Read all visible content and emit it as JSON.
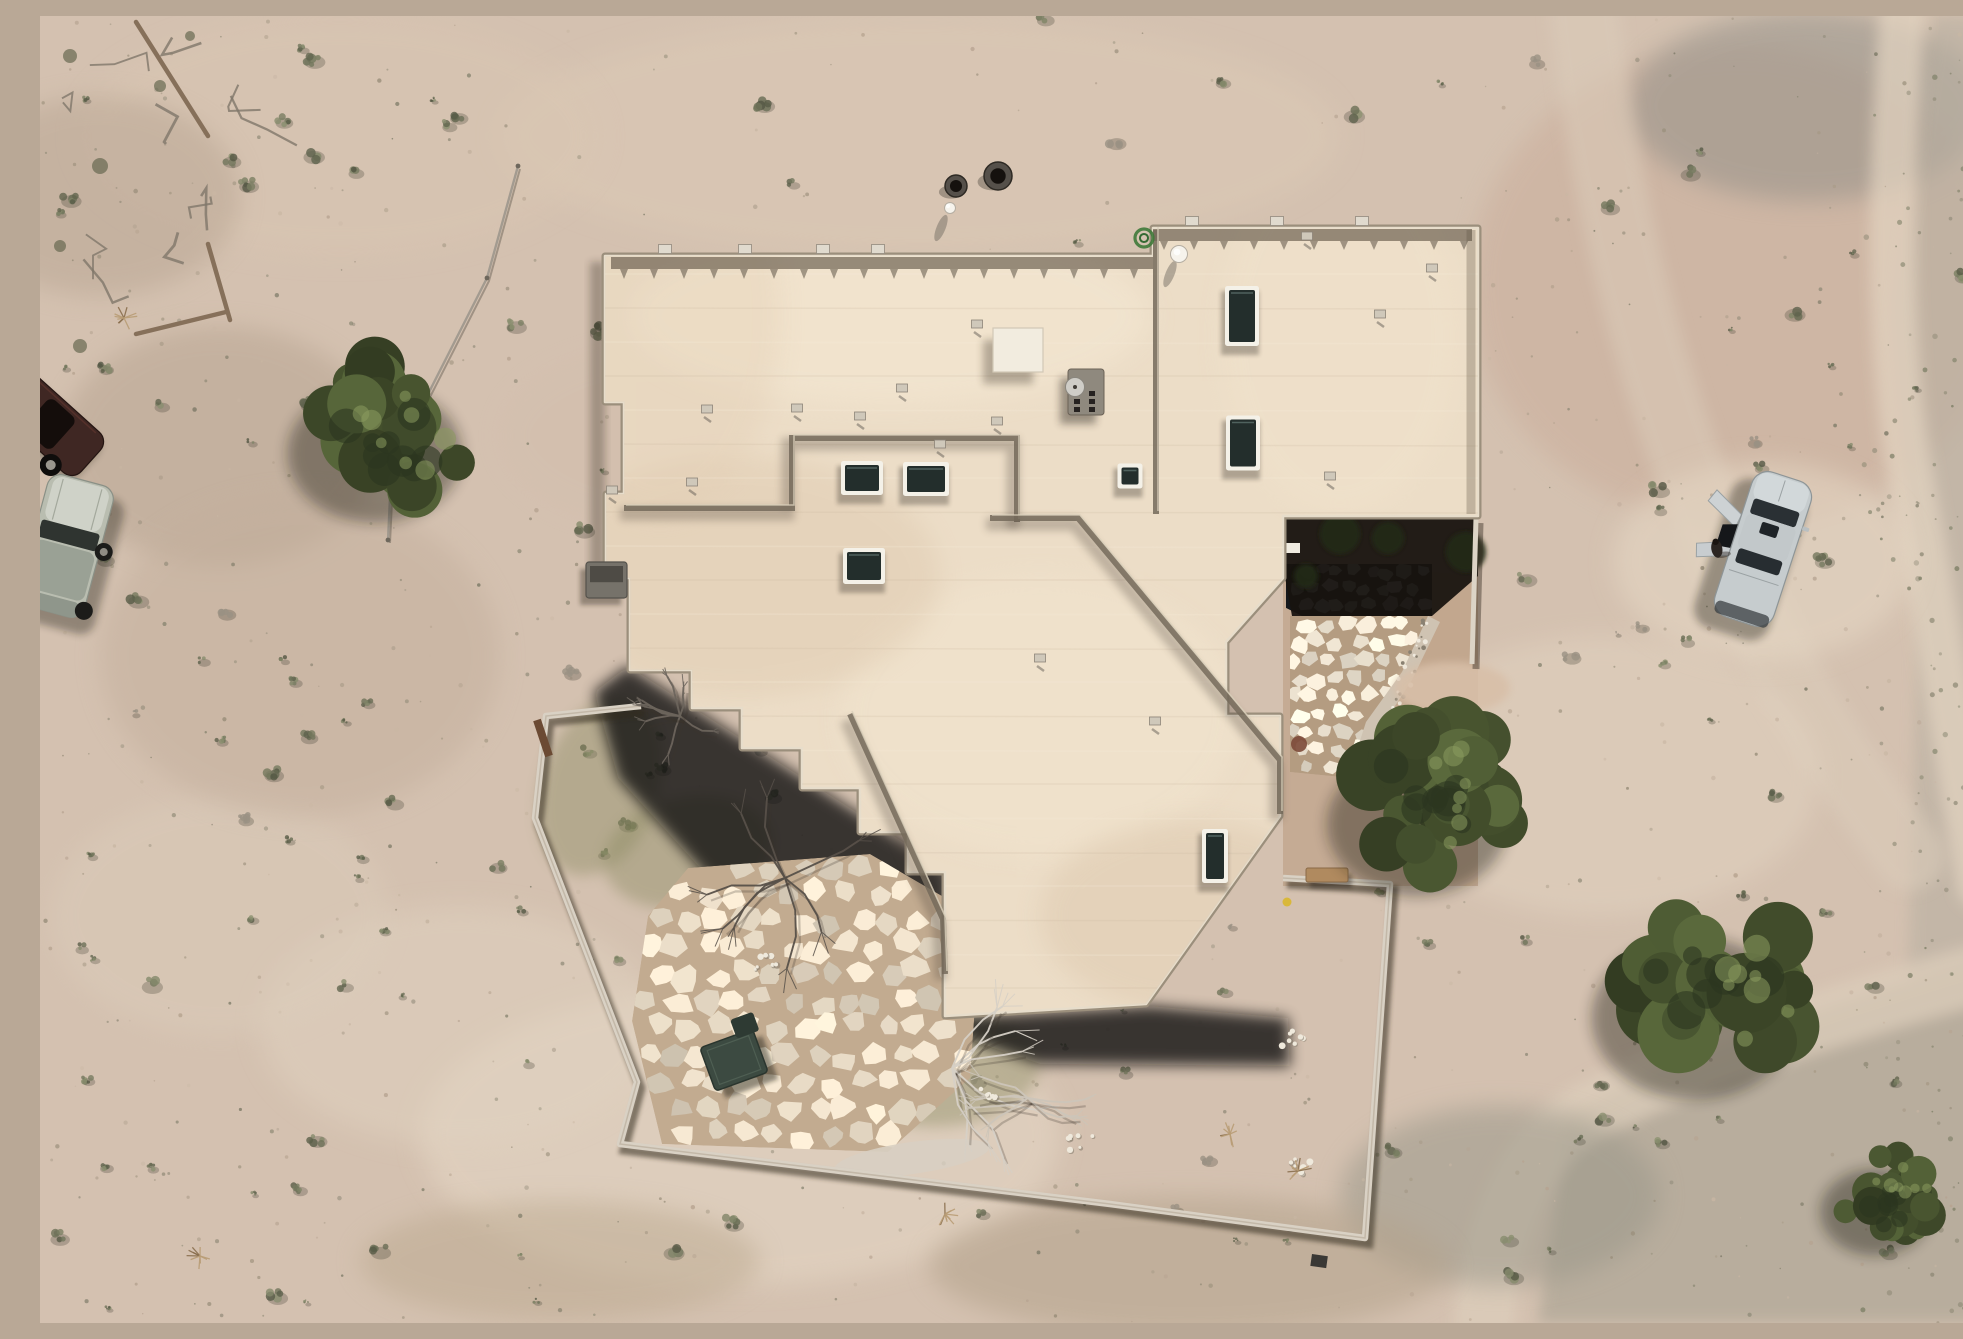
{
  "scene": {
    "type": "aerial-drone-photograph",
    "description": "Top-down aerial drone photograph of a flat-roofed adobe-style desert home with skylights, a walled backyard, flagstone entry courtyard and patio, juniper trees, desert scrub, and three vehicles parked on bare sand",
    "width": 1963,
    "height": 1307
  },
  "palette": {
    "sand": "#d4c1b0",
    "sand_light": "#e3d4c2",
    "sand_dark": "#c0ab99",
    "rocky": "#c6bab0",
    "gravel_zone": "#b2a999",
    "road": "#ddcebb",
    "roof": "#ecddc7",
    "roof_edge_light": "#e7ddcb",
    "parapet": "#9b8f7c",
    "shadow": "#0f0b07",
    "wall": "#d9d1c4",
    "wall_shadow": "#32291f",
    "stone_warm": "#e9dcc7",
    "grout_warm": "#c2ab90",
    "stone_cool": "#97a0a8",
    "grout_cool": "#15181c",
    "tree_green": "#47532f",
    "bare_branch": "#d6d0c6",
    "skylight_glass": "#232e2c",
    "skylight_frame": "#f4f1e8",
    "car_silver": "#c6ccce",
    "car_dark_red": "#3f2723",
    "car_sage": "#b9bdb0"
  },
  "ground": {
    "base": "#d4c1b0",
    "light_patches": [
      [
        700,
        1120,
        320,
        150,
        "#e6d8c6",
        0.55
      ],
      [
        420,
        1010,
        200,
        120,
        "#e0d2c0",
        0.5
      ],
      [
        880,
        120,
        420,
        120,
        "#dccab6",
        0.5
      ],
      [
        1560,
        760,
        220,
        140,
        "#e4d6c3",
        0.45
      ],
      [
        1723,
        545,
        150,
        100,
        "#e6d8c5",
        0.55
      ],
      [
        300,
        120,
        260,
        120,
        "#d9c6b2",
        0.5
      ],
      [
        620,
        420,
        160,
        90,
        "#d2bead",
        0.4
      ],
      [
        180,
        900,
        170,
        120,
        "#dccdbb",
        0.45
      ]
    ],
    "dark_patches": [
      [
        180,
        430,
        160,
        120,
        "#b5a28f",
        0.5
      ],
      [
        60,
        180,
        140,
        100,
        "#b7a492",
        0.5
      ],
      [
        1460,
        1180,
        160,
        90,
        "#9b988a",
        0.55
      ],
      [
        520,
        1245,
        200,
        60,
        "#bba98f",
        0.5
      ],
      [
        1150,
        1250,
        260,
        70,
        "#b3a28b",
        0.55
      ],
      [
        260,
        640,
        200,
        160,
        "#c3af9c",
        0.5
      ]
    ],
    "top_right_mound": [
      1700,
      270,
      270,
      240,
      "#cdb4a2",
      0.8
    ],
    "top_right_stain": [
      1768,
      90,
      180,
      95,
      "#8f8d86",
      0.5
    ],
    "right_strip": [
      [
        1895,
        0
      ],
      [
        1963,
        0
      ],
      [
        1963,
        950
      ],
      [
        1868,
        965
      ],
      [
        1878,
        600
      ],
      [
        1856,
        290
      ]
    ],
    "bottom_gravel": [
      [
        1963,
        935
      ],
      [
        1795,
        988
      ],
      [
        1618,
        1052
      ],
      [
        1528,
        1100
      ],
      [
        1498,
        1307
      ],
      [
        1963,
        1307
      ]
    ],
    "roads": [
      {
        "d": "M1862,0 C1850,170 1846,330 1872,470 C1900,620 1920,760 1940,870",
        "w": 46,
        "c": "#e3d4c1",
        "o": 0.7
      },
      {
        "d": "M1963,952 C1820,990 1640,1046 1545,1098 C1478,1136 1452,1220 1444,1307",
        "w": 60,
        "c": "#ddcebb",
        "o": 0.75
      },
      {
        "d": "M1545,0 C1560,140 1592,300 1648,450 C1706,600 1790,740 1870,840",
        "w": 70,
        "c": "#dccdbb",
        "o": 0.5
      }
    ],
    "speckles": {
      "seed": 23,
      "count": 850,
      "extra_right": 140
    },
    "shrubs": {
      "seed": 11,
      "count": 230
    }
  },
  "house": {
    "roof_fill": "#ecddc7",
    "footprint": [
      [
        565,
        240
      ],
      [
        1113,
        240
      ],
      [
        1113,
        212
      ],
      [
        1438,
        212
      ],
      [
        1438,
        500
      ],
      [
        1243,
        500
      ],
      [
        1243,
        562
      ],
      [
        1186,
        626
      ],
      [
        1186,
        700
      ],
      [
        1240,
        700
      ],
      [
        1240,
        800
      ],
      [
        1106,
        988
      ],
      [
        905,
        1000
      ],
      [
        905,
        856
      ],
      [
        868,
        856
      ],
      [
        868,
        816
      ],
      [
        820,
        816
      ],
      [
        820,
        772
      ],
      [
        762,
        772
      ],
      [
        762,
        732
      ],
      [
        702,
        732
      ],
      [
        702,
        692
      ],
      [
        652,
        692
      ],
      [
        652,
        654
      ],
      [
        590,
        654
      ],
      [
        590,
        562
      ],
      [
        566,
        562
      ],
      [
        566,
        478
      ],
      [
        584,
        478
      ],
      [
        584,
        386
      ],
      [
        565,
        386
      ]
    ],
    "ground_shadow": [
      [
        588,
        650
      ],
      [
        910,
        856
      ],
      [
        908,
        1002
      ],
      [
        1110,
        990
      ],
      [
        1248,
        1002
      ],
      [
        1250,
        1050
      ],
      [
        1000,
        1048
      ],
      [
        860,
        1000
      ],
      [
        700,
        896
      ],
      [
        578,
        762
      ],
      [
        554,
        676
      ]
    ],
    "parapet_bands": [
      [
        [
          571,
          247
        ],
        [
          1113,
          247
        ]
      ],
      [
        [
          1113,
          219
        ],
        [
          1432,
          219
        ]
      ]
    ],
    "right_band": [
      [
        1431,
        214
      ],
      [
        1431,
        498
      ]
    ],
    "interior_lines": [
      [
        [
          584,
          492
        ],
        [
          752,
          492
        ],
        [
          752,
          422
        ],
        [
          977,
          422
        ],
        [
          977,
          506
        ]
      ],
      [
        [
          950,
          502
        ],
        [
          1038,
          502
        ],
        [
          1240,
          744
        ],
        [
          1240,
          798
        ]
      ],
      [
        [
          810,
          698
        ],
        [
          903,
          903
        ],
        [
          905,
          958
        ]
      ],
      [
        [
          1116,
          214
        ],
        [
          1116,
          498
        ]
      ]
    ],
    "skylights": [
      [
        822,
        462,
        42,
        34
      ],
      [
        886,
        463,
        46,
        34
      ],
      [
        824,
        550,
        42,
        36
      ],
      [
        1090,
        460,
        25,
        25
      ],
      [
        1202,
        300,
        34,
        60
      ],
      [
        1203,
        427,
        34,
        55
      ],
      [
        1175,
        840,
        26,
        54
      ]
    ],
    "roof_vents": [
      [
        667,
        393
      ],
      [
        757,
        392
      ],
      [
        820,
        400
      ],
      [
        900,
        428
      ],
      [
        937,
        308
      ],
      [
        957,
        405
      ],
      [
        652,
        466
      ],
      [
        572,
        474
      ],
      [
        1267,
        220
      ],
      [
        1340,
        298
      ],
      [
        1392,
        252
      ],
      [
        1290,
        460
      ],
      [
        862,
        372
      ],
      [
        1000,
        642
      ],
      [
        1115,
        705
      ]
    ],
    "parapet_vents": [
      [
        625,
        233
      ],
      [
        705,
        233
      ],
      [
        783,
        233
      ],
      [
        838,
        233
      ],
      [
        1152,
        205
      ],
      [
        1237,
        205
      ],
      [
        1322,
        205
      ]
    ],
    "hatch": [
      953,
      312,
      50,
      44
    ],
    "chimney": [
      1028,
      353,
      36,
      46
    ],
    "dish": [
      1035,
      371,
      9.5
    ],
    "domes": [
      [
        1139,
        238,
        8.5
      ],
      [
        910,
        192,
        5.5
      ]
    ],
    "ac_unit": [
      546,
      546,
      41,
      36
    ],
    "hose": [
      1104,
      222,
      9
    ]
  },
  "entry_court": {
    "dirt": [
      [
        1243,
        500
      ],
      [
        1438,
        500
      ],
      [
        1438,
        870
      ],
      [
        1243,
        870
      ]
    ],
    "side_dirt": [
      [
        1392,
        556
      ],
      [
        1438,
        560
      ],
      [
        1438,
        768
      ],
      [
        1316,
        768
      ],
      [
        1330,
        712
      ],
      [
        1370,
        660
      ]
    ],
    "dark": [
      [
        1243,
        500
      ],
      [
        1438,
        500
      ],
      [
        1438,
        560
      ],
      [
        1392,
        600
      ],
      [
        1252,
        600
      ],
      [
        1243,
        550
      ]
    ],
    "shaded_stones": [
      [
        1246,
        548
      ],
      [
        1392,
        548
      ],
      [
        1392,
        600
      ],
      [
        1262,
        600
      ],
      [
        1246,
        592
      ]
    ],
    "sun_stones": [
      [
        1250,
        600
      ],
      [
        1388,
        600
      ],
      [
        1368,
        660
      ],
      [
        1330,
        710
      ],
      [
        1312,
        762
      ],
      [
        1250,
        756
      ]
    ],
    "pebble_strip": [
      [
        1388,
        600
      ],
      [
        1400,
        606
      ],
      [
        1372,
        664
      ],
      [
        1338,
        716
      ],
      [
        1322,
        768
      ],
      [
        1308,
        762
      ],
      [
        1326,
        706
      ],
      [
        1362,
        656
      ]
    ],
    "plants": [
      [
        1300,
        518,
        20
      ],
      [
        1348,
        522,
        16
      ],
      [
        1426,
        536,
        20
      ],
      [
        1266,
        560,
        12
      ]
    ],
    "step": [
      1246,
      527,
      14,
      10
    ],
    "bench": [
      1266,
      852,
      42,
      14
    ],
    "red_shrub": [
      1259,
      728,
      8
    ],
    "dry_mound": [
      1412,
      672,
      58,
      26
    ],
    "yellow_item": [
      1247,
      886,
      4.5
    ],
    "stub_wall": [
      [
        1436,
        502
      ],
      [
        1432,
        648
      ]
    ]
  },
  "patio": {
    "poly": [
      [
        648,
        852
      ],
      [
        830,
        838
      ],
      [
        902,
        880
      ],
      [
        938,
        948
      ],
      [
        930,
        1062
      ],
      [
        848,
        1136
      ],
      [
        622,
        1128
      ],
      [
        592,
        1005
      ],
      [
        608,
        900
      ]
    ],
    "stone": "#e9dcc7",
    "grout": "#c2ab90",
    "cell": 30,
    "table": [
      694,
      1044,
      56,
      46,
      -20
    ],
    "table2": [
      712,
      1016,
      24,
      20,
      -20
    ],
    "gravel_band": [
      872,
      1142,
      78,
      16,
      -8
    ]
  },
  "yard": {
    "wall": [
      [
        601,
        690
      ],
      [
        506,
        700
      ],
      [
        495,
        802
      ],
      [
        597,
        1066
      ],
      [
        580,
        1128
      ],
      [
        1070,
        1188
      ],
      [
        1325,
        1222
      ],
      [
        1350,
        868
      ],
      [
        1243,
        862
      ]
    ],
    "gate": [
      [
        497,
        704
      ],
      [
        509,
        740
      ]
    ],
    "green_patches": [
      [
        560,
        770,
        58,
        92,
        18
      ],
      [
        648,
        836,
        85,
        55,
        -12
      ],
      [
        905,
        1055,
        95,
        55,
        -6
      ],
      [
        766,
        926,
        70,
        46,
        8
      ]
    ],
    "rock_clusters": [
      [
        1040,
        1128
      ],
      [
        1255,
        1022
      ],
      [
        952,
        1080
      ],
      [
        728,
        948
      ],
      [
        1262,
        1152
      ]
    ],
    "dry_bushes": [
      [
        1258,
        1155
      ],
      [
        1190,
        1118
      ],
      [
        905,
        1198
      ],
      [
        160,
        1240
      ],
      [
        84,
        302
      ]
    ],
    "trash": [
      1272,
      1238,
      16,
      12
    ]
  },
  "trees": {
    "green": [
      [
        355,
        412,
        92
      ],
      [
        1398,
        782,
        95
      ],
      [
        1678,
        972,
        108
      ],
      [
        1848,
        1180,
        58
      ]
    ],
    "bare": [
      [
        912,
        1052,
        95,
        "#d6d0c6"
      ],
      [
        745,
        862,
        88,
        "#575049"
      ],
      [
        988,
        1082,
        60,
        "#ccc5b9"
      ],
      [
        640,
        700,
        45,
        "#6b645c"
      ]
    ]
  },
  "vehicles": {
    "sedan": {
      "cx": 1723,
      "cy": 533,
      "rot": 18,
      "body": "#c6ccce",
      "trim": "#8e9597",
      "glass": "#2a3034"
    },
    "dark_car": {
      "cx": 10,
      "cy": 408,
      "rot": 42,
      "body": "#3f2723",
      "glass": "#140d0b"
    },
    "suv": {
      "cx": 26,
      "cy": 530,
      "rot": 15,
      "body": "#b9bdb0",
      "glass": "#2f3430"
    }
  },
  "props": {
    "pots": [
      [
        916,
        170,
        11
      ],
      [
        958,
        160,
        14
      ]
    ],
    "fence": [
      [
        478,
        150
      ],
      [
        447,
        262
      ],
      [
        384,
        386
      ],
      [
        352,
        440
      ],
      [
        348,
        524
      ]
    ],
    "rails": [
      [
        [
          96,
          6
        ],
        [
          168,
          120
        ]
      ],
      [
        [
          168,
          228
        ],
        [
          190,
          304
        ]
      ],
      [
        [
          96,
          318
        ],
        [
          186,
          296
        ]
      ]
    ],
    "debris_seed": 5
  }
}
